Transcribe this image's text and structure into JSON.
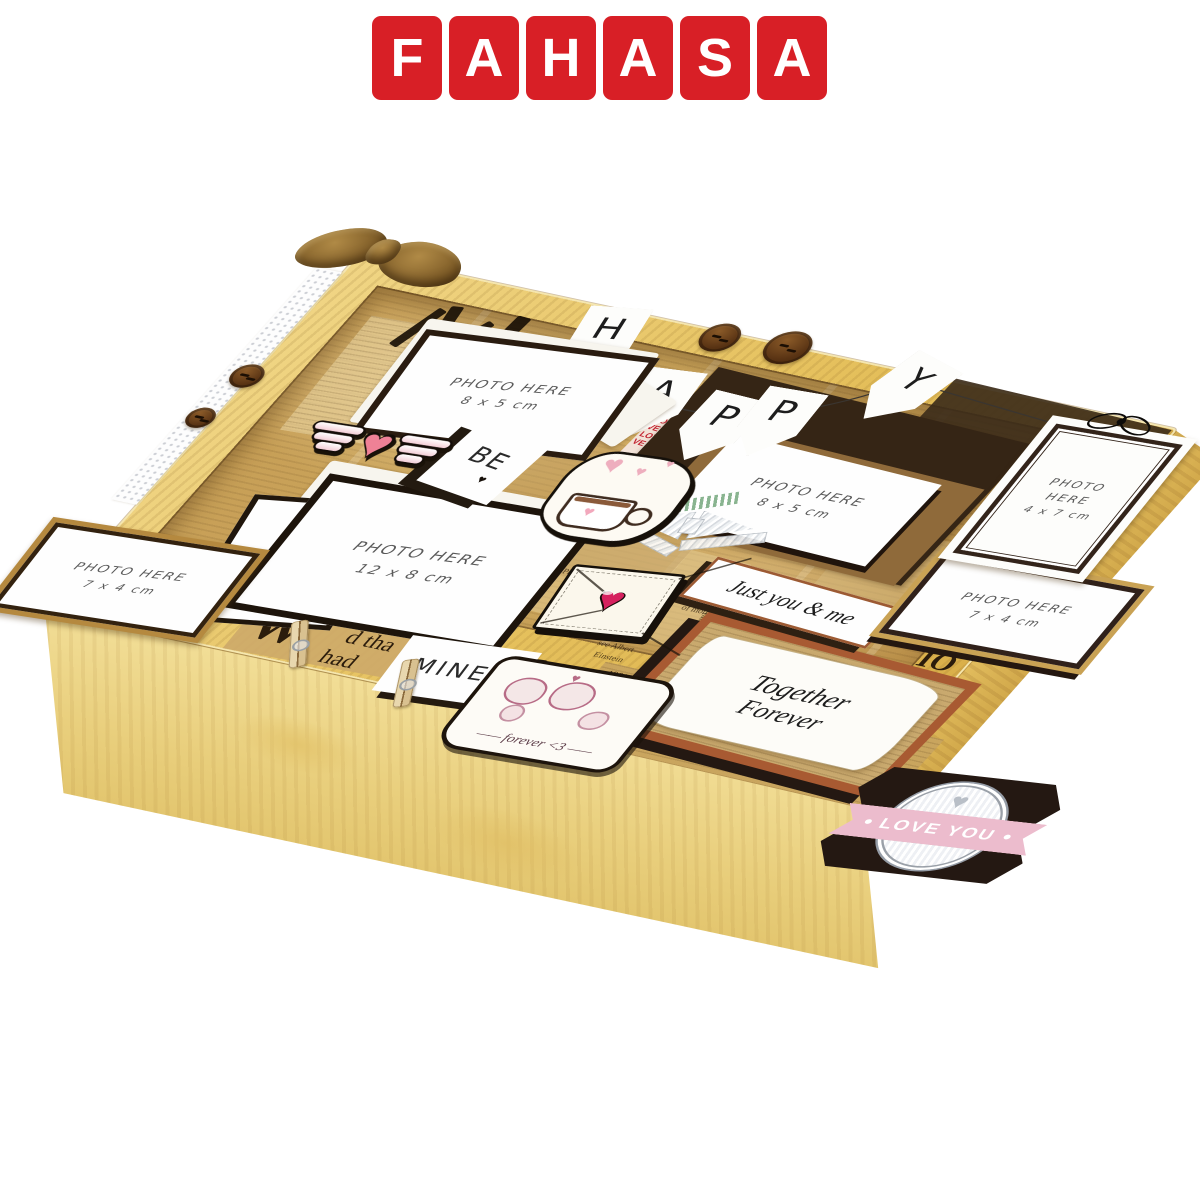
{
  "brand": {
    "name": "FAHASA",
    "letters": [
      "F",
      "A",
      "H",
      "A",
      "S",
      "A"
    ],
    "logo_red": "#d81f26"
  },
  "banner": {
    "letters": [
      "H",
      "A",
      "P",
      "P",
      "Y"
    ]
  },
  "photo_slots": {
    "top_left": {
      "line1": "PHOTO HERE",
      "line2": "8 x 5 cm"
    },
    "center": {
      "line1": "PHOTO HERE",
      "line2": "12 x 8 cm"
    },
    "left": {
      "line1": "PHOTO HERE",
      "line2": "7 x 4 cm"
    },
    "middle": {
      "line1": "PHOTO HERE",
      "line2": "8 x 5 cm"
    },
    "tag": {
      "line1": "PHOTO",
      "line2": "HERE",
      "line3": "4 x 7 cm"
    },
    "right": {
      "line1": "PHOTO HERE",
      "line2": "7 x 4 cm"
    }
  },
  "cards": {
    "be": "BE",
    "mine": "MINE",
    "just_you_me": "Just you & me",
    "together_line1": "Together",
    "together_line2": "Forever",
    "love_you": "LOVE YOU",
    "forever_tag": "forever <3"
  },
  "glyphs": {
    "heart": "♥"
  },
  "love_collage": "LOVE LOVE LOVE LOVE LOVE LOVE LOVE LOVE LOVE LOVE LOVE LOVE LOVE LOVE LOVE",
  "newspaper": {
    "fragments": [
      "d tha",
      "had",
      "W",
      "IO",
      "1901, after",
      "1912 and 1914",
      "Einstein",
      "professor",
      "He later",
      "Quantum",
      "of motion",
      "see Albert",
      "People",
      "Philosophy",
      "(alongside",
      "of the"
    ]
  },
  "colors": {
    "wood": "#e7c66d",
    "kraft": "#c8a158",
    "dark_brown": "#2f2012",
    "rust": "#a85a32",
    "banner_pink": "#ecbccd",
    "heart_pink": "#ef8196"
  }
}
